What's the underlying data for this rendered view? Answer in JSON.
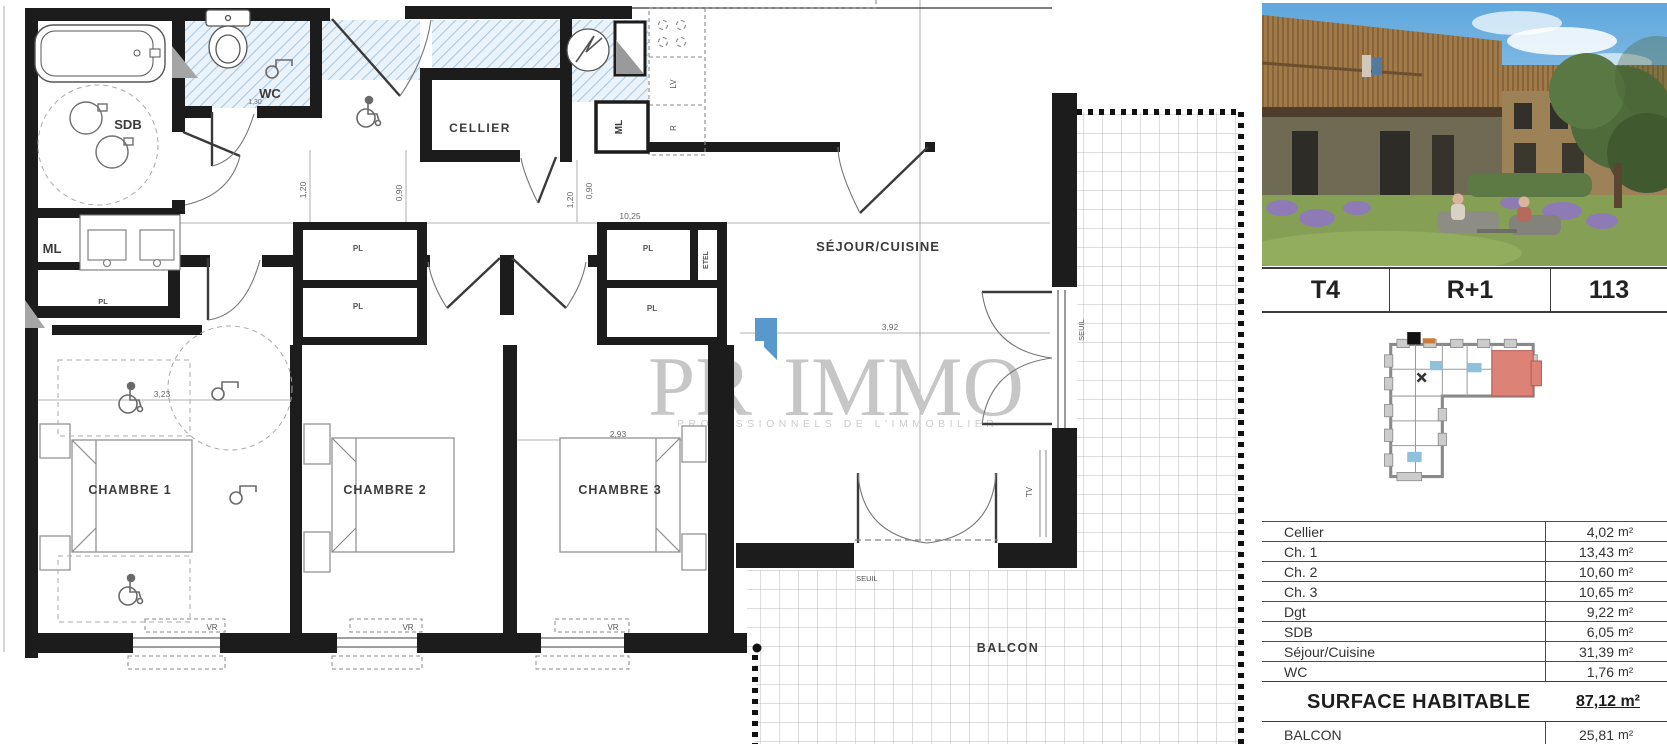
{
  "plan": {
    "rooms": {
      "wc": "WC",
      "sdb": "SDB",
      "cellier": "CELLIER",
      "sejour": "SÉJOUR/CUISINE",
      "chambre1": "CHAMBRE 1",
      "chambre2": "CHAMBRE 2",
      "chambre3": "CHAMBRE 3",
      "balcon": "BALCON"
    },
    "tags": {
      "ml": "ML",
      "pl": "PL",
      "etel": "ETEL",
      "lv": "LV",
      "fridge": "R",
      "tv": "TV",
      "seuil": "SEUIL",
      "vr": "VR"
    },
    "dims": {
      "total_width": "10,25",
      "sejour_width": "3,92",
      "ch3_width": "2,93",
      "ch1_width": "3,23",
      "door_120": "1,20",
      "door_090": "0,90",
      "wc_width": "1,30"
    }
  },
  "watermark": {
    "part1": "PR",
    "part2": "IMMO",
    "subtitle": "PROFESSIONNELS DE L'IMMOBILIER",
    "accent_color": "#5898cc",
    "text_color": "#c6c6c6"
  },
  "sidebar": {
    "unit": {
      "type": "T4",
      "floor": "R+1",
      "number": "113"
    },
    "areas": {
      "rows": [
        {
          "label": "Cellier",
          "value": "4,02",
          "unit": "m²"
        },
        {
          "label": "Ch. 1",
          "value": "13,43",
          "unit": "m²"
        },
        {
          "label": "Ch. 2",
          "value": "10,60",
          "unit": "m²"
        },
        {
          "label": "Ch. 3",
          "value": "10,65",
          "unit": "m²"
        },
        {
          "label": "Dgt",
          "value": "9,22",
          "unit": "m²"
        },
        {
          "label": "SDB",
          "value": "6,05",
          "unit": "m²"
        },
        {
          "label": "Séjour/Cuisine",
          "value": "31,39",
          "unit": "m²"
        },
        {
          "label": "WC",
          "value": "1,76",
          "unit": "m²"
        }
      ],
      "total": {
        "label": "SURFACE HABITABLE",
        "value": "87,12 m²"
      },
      "balcony": {
        "label": "BALCON",
        "value": "25,81",
        "unit": "m²"
      }
    }
  }
}
